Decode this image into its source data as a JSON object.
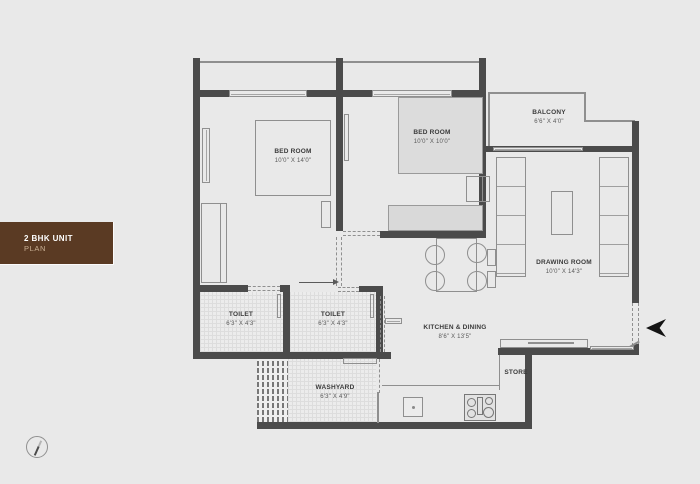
{
  "title": {
    "line1": "2 BHK UNIT",
    "line2": "PLAN"
  },
  "rooms": [
    {
      "name": "BED ROOM",
      "dims": "10'0\" X 14'0\""
    },
    {
      "name": "BED ROOM",
      "dims": "10'0\" X 10'0\""
    },
    {
      "name": "BALCONY",
      "dims": "6'6\" X 4'0\""
    },
    {
      "name": "DRAWING ROOM",
      "dims": "10'0\" X 14'3\""
    },
    {
      "name": "TOILET",
      "dims": "6'3\" X 4'3\""
    },
    {
      "name": "TOILET",
      "dims": "6'3\" X 4'3\""
    },
    {
      "name": "KITCHEN & DINING",
      "dims": "8'6\" X 13'5\""
    },
    {
      "name": "WASHYARD",
      "dims": "6'3\" X 4'9\""
    },
    {
      "name": "STORE",
      "dims": ""
    }
  ],
  "icons": {
    "entrance_arrow": "entrance-direction-arrow",
    "north_indicator": "north-compass"
  },
  "colors": {
    "background": "#e9e9e9",
    "wall": "#4b4b4b",
    "furniture_line": "#8f8f8f",
    "tag_brown": "#5a3a23",
    "tag_text": "#ffffff",
    "tag_subtext": "#c9b094",
    "label_text": "#3b3b3b"
  }
}
